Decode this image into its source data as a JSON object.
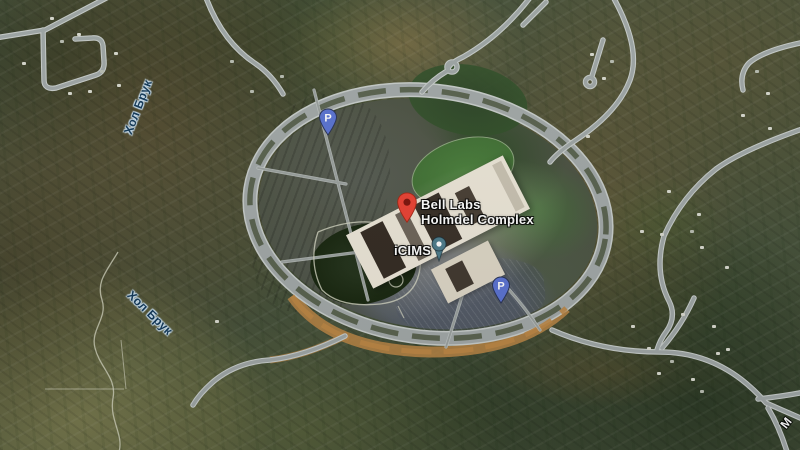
{
  "labels": {
    "main_poi_line1": "Bell Labs",
    "main_poi_line2": "Holmdel Complex",
    "secondary_poi": "iCIMS",
    "water_top": "Хол Брук",
    "water_bottom": "Хол Брук",
    "road_partial": "M",
    "parking_glyph": "P"
  },
  "markers": {
    "main_pin_color": "#EA4335",
    "main_pin_inner": "#7E150D",
    "parking_pin_color": "#5B73D2",
    "icims_pin_color": "#4E7C8C"
  },
  "palette": {
    "road": "#9FA6A6",
    "road_casing": "#C7CCCA",
    "road_tan": "#BD8746",
    "forest": "#2C3A26",
    "field_olive": "#75774C",
    "parking_lot": "#53584F",
    "building": "#ECE6D8",
    "lawn": "#49793B",
    "pond": "#1E2D18",
    "water_label_color": "#143A5A"
  }
}
